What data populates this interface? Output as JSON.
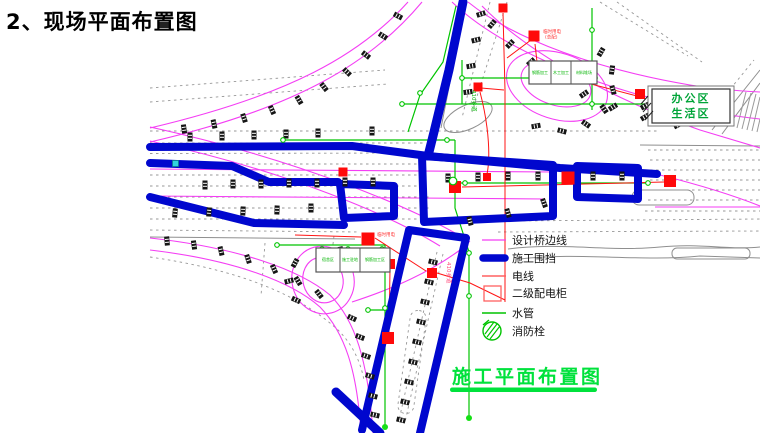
{
  "page": {
    "title": "2、现场平面布置图",
    "caption": "施工平面布置图"
  },
  "area_box": {
    "line1": "办公区",
    "line2": "生活区"
  },
  "legend": {
    "items": [
      {
        "label": "设计桥边线",
        "type": "line",
        "color": "#f43ef4"
      },
      {
        "label": "施工围挡",
        "type": "thick-line",
        "color": "#0007ce"
      },
      {
        "label": "电线",
        "type": "line",
        "color": "#ff6060"
      },
      {
        "label": "二级配电柜",
        "type": "square",
        "color": "#ff6060"
      },
      {
        "label": "水管",
        "type": "line",
        "color": "#00c400"
      },
      {
        "label": "消防栓",
        "type": "hydrant",
        "color": "#00c400"
      }
    ]
  },
  "buildings": {
    "box1_cells": [
      "钢筋加工",
      "木工加工",
      "材料堆场"
    ],
    "box2_cells": [
      "宿舍区",
      "施工驻地",
      "钢筋加工区"
    ]
  },
  "tiny_labels": {
    "power1": "临时用电",
    "power1b": "(总配)",
    "power2": "临时用电",
    "road_green": "410乡道",
    "road_red": "410乡道"
  },
  "colors": {
    "bridge_magenta": "#f43ef4",
    "fence_blue": "#0007ce",
    "wire_red": "#ff1414",
    "legend_red": "#ff6060",
    "pipe_green": "#00c400",
    "caption_green": "#00e23c",
    "area_text_green": "#00a438",
    "road_gray": "#8f8f8f",
    "cabinet_red": "#ff0a0a"
  },
  "drawing": {
    "markers": [
      [
        398,
        16,
        -62
      ],
      [
        383,
        36,
        -58
      ],
      [
        366,
        55,
        -52
      ],
      [
        347,
        72,
        -46
      ],
      [
        324,
        87,
        -38
      ],
      [
        299,
        100,
        -30
      ],
      [
        272,
        110,
        -24
      ],
      [
        244,
        118,
        -18
      ],
      [
        214,
        124,
        -12
      ],
      [
        184,
        129,
        -8
      ],
      [
        481,
        14,
        72
      ],
      [
        476,
        40,
        76
      ],
      [
        471,
        66,
        80
      ],
      [
        468,
        92,
        82
      ],
      [
        492,
        24,
        40
      ],
      [
        510,
        44,
        44
      ],
      [
        531,
        62,
        48
      ],
      [
        556,
        79,
        52
      ],
      [
        584,
        94,
        55
      ],
      [
        613,
        107,
        58
      ],
      [
        645,
        117,
        60
      ],
      [
        678,
        125,
        63
      ],
      [
        601,
        52,
        30
      ],
      [
        612,
        70,
        8
      ],
      [
        613,
        90,
        -15
      ],
      [
        604,
        109,
        -35
      ],
      [
        586,
        124,
        -55
      ],
      [
        562,
        131,
        -75
      ],
      [
        536,
        126,
        -100
      ],
      [
        645,
        106,
        62
      ],
      [
        658,
        120,
        66
      ],
      [
        205,
        185,
        0
      ],
      [
        233,
        184,
        0
      ],
      [
        261,
        184,
        0
      ],
      [
        289,
        183,
        0
      ],
      [
        317,
        183,
        0
      ],
      [
        345,
        182,
        0
      ],
      [
        373,
        182,
        0
      ],
      [
        448,
        178,
        0
      ],
      [
        478,
        177,
        0
      ],
      [
        508,
        176,
        0
      ],
      [
        538,
        176,
        0
      ],
      [
        593,
        176,
        0
      ],
      [
        622,
        176,
        0
      ],
      [
        190,
        137,
        0
      ],
      [
        222,
        136,
        0
      ],
      [
        254,
        135,
        0
      ],
      [
        286,
        134,
        0
      ],
      [
        318,
        133,
        0
      ],
      [
        372,
        131,
        0
      ],
      [
        175,
        213,
        5
      ],
      [
        209,
        212,
        4
      ],
      [
        243,
        211,
        3
      ],
      [
        277,
        210,
        2
      ],
      [
        311,
        208,
        0
      ],
      [
        470,
        221,
        -14
      ],
      [
        508,
        213,
        -17
      ],
      [
        544,
        203,
        -20
      ],
      [
        167,
        241,
        -5
      ],
      [
        194,
        245,
        -8
      ],
      [
        221,
        251,
        -13
      ],
      [
        248,
        259,
        -18
      ],
      [
        274,
        269,
        -24
      ],
      [
        298,
        281,
        -31
      ],
      [
        319,
        294,
        -38
      ],
      [
        295,
        263,
        28
      ],
      [
        289,
        281,
        75
      ],
      [
        296,
        300,
        115
      ],
      [
        341,
        251,
        -12
      ],
      [
        355,
        263,
        -35
      ],
      [
        352,
        318,
        -65
      ],
      [
        360,
        337,
        -69
      ],
      [
        366,
        356,
        -71
      ],
      [
        370,
        376,
        -73
      ],
      [
        373,
        396,
        -75
      ],
      [
        375,
        415,
        -77
      ],
      [
        433,
        262,
        104
      ],
      [
        429,
        282,
        104
      ],
      [
        425,
        302,
        104
      ],
      [
        421,
        322,
        104
      ],
      [
        417,
        342,
        104
      ],
      [
        413,
        362,
        104
      ],
      [
        409,
        382,
        104
      ],
      [
        405,
        402,
        104
      ],
      [
        401,
        420,
        104
      ]
    ],
    "cabinets": [
      [
        503,
        8,
        9
      ],
      [
        534,
        36,
        11
      ],
      [
        538,
        67,
        9
      ],
      [
        478,
        87,
        9
      ],
      [
        640,
        94,
        10
      ],
      [
        343,
        172,
        9
      ],
      [
        487,
        177,
        8
      ],
      [
        455,
        187,
        12
      ],
      [
        568,
        178,
        13
      ],
      [
        670,
        181,
        12
      ],
      [
        368,
        239,
        13
      ],
      [
        390,
        264,
        10
      ],
      [
        432,
        273,
        10
      ],
      [
        388,
        338,
        12
      ]
    ],
    "cabinet_circle": [
      664,
      100,
      5.5
    ],
    "pipe_nodes": [
      [
        283,
        140
      ],
      [
        447,
        140
      ],
      [
        420,
        93
      ],
      [
        592,
        30
      ],
      [
        592,
        104
      ],
      [
        402,
        104
      ],
      [
        462,
        78
      ],
      [
        595,
        78
      ],
      [
        656,
        104
      ],
      [
        724,
        117
      ],
      [
        322,
        249
      ],
      [
        348,
        249
      ],
      [
        382,
        249
      ],
      [
        277,
        245
      ],
      [
        385,
        308
      ],
      [
        469,
        296
      ],
      [
        469,
        253
      ],
      [
        368,
        310
      ],
      [
        465,
        183
      ],
      [
        648,
        183
      ]
    ],
    "pipe_dots": [
      [
        385,
        427
      ],
      [
        469,
        418
      ],
      [
        652,
        120
      ],
      [
        728,
        120
      ]
    ],
    "hydrant_node": [
      453,
      181
    ]
  }
}
